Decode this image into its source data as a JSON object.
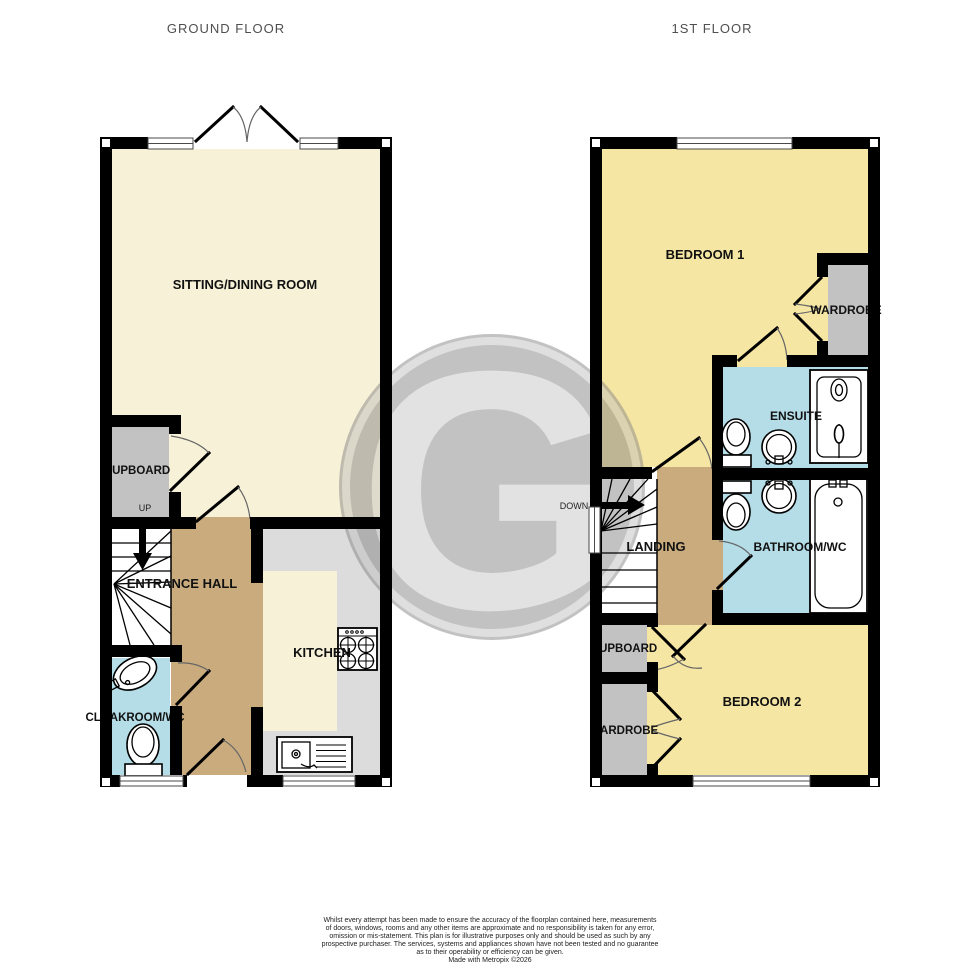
{
  "ground": {
    "title": "GROUND FLOOR",
    "rooms": {
      "sitting": "SITTING/DINING ROOM",
      "cupboard": "CUPBOARD",
      "up": "UP",
      "hall": "ENTRANCE HALL",
      "kitchen": "KITCHEN",
      "cloakroom": "CLOAKROOM/WC"
    }
  },
  "first": {
    "title": "1ST FLOOR",
    "rooms": {
      "bedroom1": "BEDROOM 1",
      "wardrobe1": "WARDROBE",
      "ensuite": "ENSUITE",
      "down": "DOWN",
      "landing": "LANDING",
      "bathroom": "BATHROOM/WC",
      "cupboard": "CUPBOARD",
      "wardrobe2": "WARDROBE",
      "bedroom2": "BEDROOM 2"
    }
  },
  "watermark": {
    "letter": "G"
  },
  "disclaimer": {
    "lines": [
      "Whilst every attempt has been made to ensure the accuracy of the floorplan contained here, measurements",
      "of doors, windows, rooms and any other items are approximate and no responsibility is taken for any error,",
      "omission or mis-statement. This plan is for illustrative purposes only and should be used as such by any",
      "prospective purchaser. The services, systems and appliances shown have not been tested and no guarantee",
      "as to their operability or efficiency can be given."
    ],
    "credit": "Made with Metropix ©2026"
  },
  "colors": {
    "cream": "#f7f1d7",
    "yellow": "#f5e6a4",
    "tan": "#c9ab7e",
    "blue": "#b5dde7",
    "gray_storage": "#c3c2c2",
    "gray_counter": "#dcdcdc",
    "stair_white": "#ffffff",
    "wall": "#000000",
    "watermark_disc": "#828282",
    "watermark_ring": "#bdbdbd",
    "watermark_letter": "#c4c4c4"
  }
}
